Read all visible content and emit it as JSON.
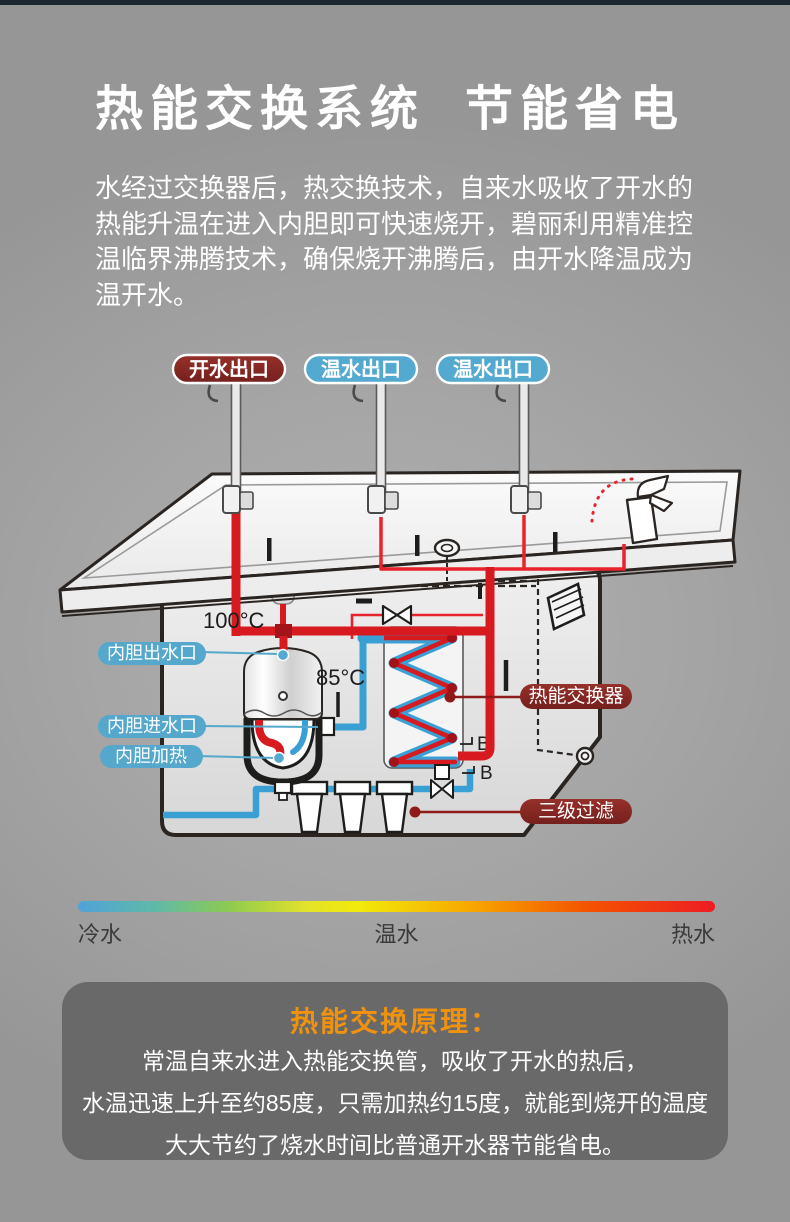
{
  "header": {
    "title_left": "热能交换系统",
    "title_right": "节能省电"
  },
  "intro": {
    "lines": [
      "水经过交换器后，热交换技术，自来水吸收了开水的",
      "热能升温在进入内胆即可快速烧开，碧丽利用精准控",
      "温临界沸腾技术，确保烧开沸腾后，由开水降温成为",
      "温开水。"
    ]
  },
  "diagram": {
    "outlet_labels": [
      {
        "text": "开水出口",
        "type": "hot"
      },
      {
        "text": "温水出口",
        "type": "warm"
      },
      {
        "text": "温水出口",
        "type": "warm"
      }
    ],
    "temp_boiling": "100°C",
    "temp_warm": "85°C",
    "left_labels": [
      "内胆出水口",
      "内胆进水口",
      "内胆加热"
    ],
    "right_labels": [
      "热能交换器",
      "三级过滤"
    ],
    "port_marks": [
      "B",
      "B"
    ],
    "colors": {
      "hot_pipe": "#d71920",
      "cold_pipe": "#3aa0d4",
      "hot_pill": "#8e2a26",
      "warm_pill": "#53a9cf"
    }
  },
  "temperature_scale": {
    "cold": "冷水",
    "warm": "温水",
    "hot": "热水"
  },
  "principle": {
    "title": "热能交换原理：",
    "lines": [
      "常温自来水进入热能交换管，吸收了开水的热后，",
      "水温迅速上升至约85度，只需加热约15度，就能到烧开的温度",
      "大大节约了烧水时间比普通开水器节能省电。"
    ]
  }
}
